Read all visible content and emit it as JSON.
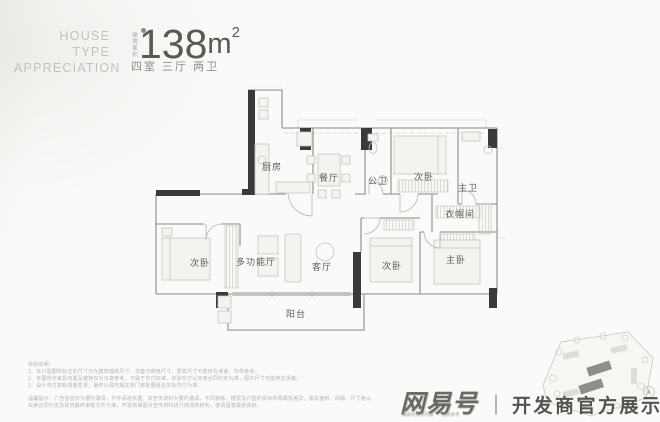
{
  "header": {
    "eyebrow_line1": "HOUSE",
    "eyebrow_line2": "TYPE",
    "eyebrow_line3": "APPRECIATION",
    "area_label": "建筑面积",
    "area_value": "138",
    "area_unit": "m",
    "area_sup": "2",
    "layout_summary": "四室 三厅 两卫"
  },
  "floorplan": {
    "rooms": [
      {
        "label": "厨房"
      },
      {
        "label": "餐厅"
      },
      {
        "label": "公卫"
      },
      {
        "label": "次卧"
      },
      {
        "label": "主卫"
      },
      {
        "label": "衣帽间"
      },
      {
        "label": "次卧"
      },
      {
        "label": "多功能厅"
      },
      {
        "label": "客厅"
      },
      {
        "label": "次卧"
      },
      {
        "label": "主卧"
      },
      {
        "label": "阳台"
      }
    ]
  },
  "disclaimer": {
    "title": "特别说明：",
    "line1": "1、本户型图所标注的尺寸均为建筑轴线尺寸，非套内使用尺寸，层高尺寸可能存在误差，仅供参考；",
    "line2": "2、本图所示家具布置及装饰仅为示意参考，不属于交付标准，实际交付以买卖合同约定为准，图中尺寸可能存在误差；",
    "line3": "3、设计单位如有调整变更，最终以政府相关部门审批图纸及实际交付为准。",
    "notice1": "温馨提示：广告信息仅为要约邀请，不作承诺依据。本宣传资料为要约邀请，不同楼栋、楼层及户型的实际布局或有差异，相关面积、间隔、尺寸等以",
    "notice2": "买卖合同约定及政府最终审批文件为准，开发商保留对宣传资料进行修改的权利，敬请留意最新资料。"
  },
  "watermark": {
    "brand": "网易号",
    "divider": "｜",
    "text": "开发商官方展示中心",
    "sub_left": "网易号官方内容",
    "sub_right": "仅供参考"
  },
  "colors": {
    "accent_dark": "#565b53",
    "wall_gray": "#9d9d97",
    "column_black": "#3a3a38",
    "label_gray": "#5c5c57",
    "watermark_gray": "#3c3c38"
  }
}
